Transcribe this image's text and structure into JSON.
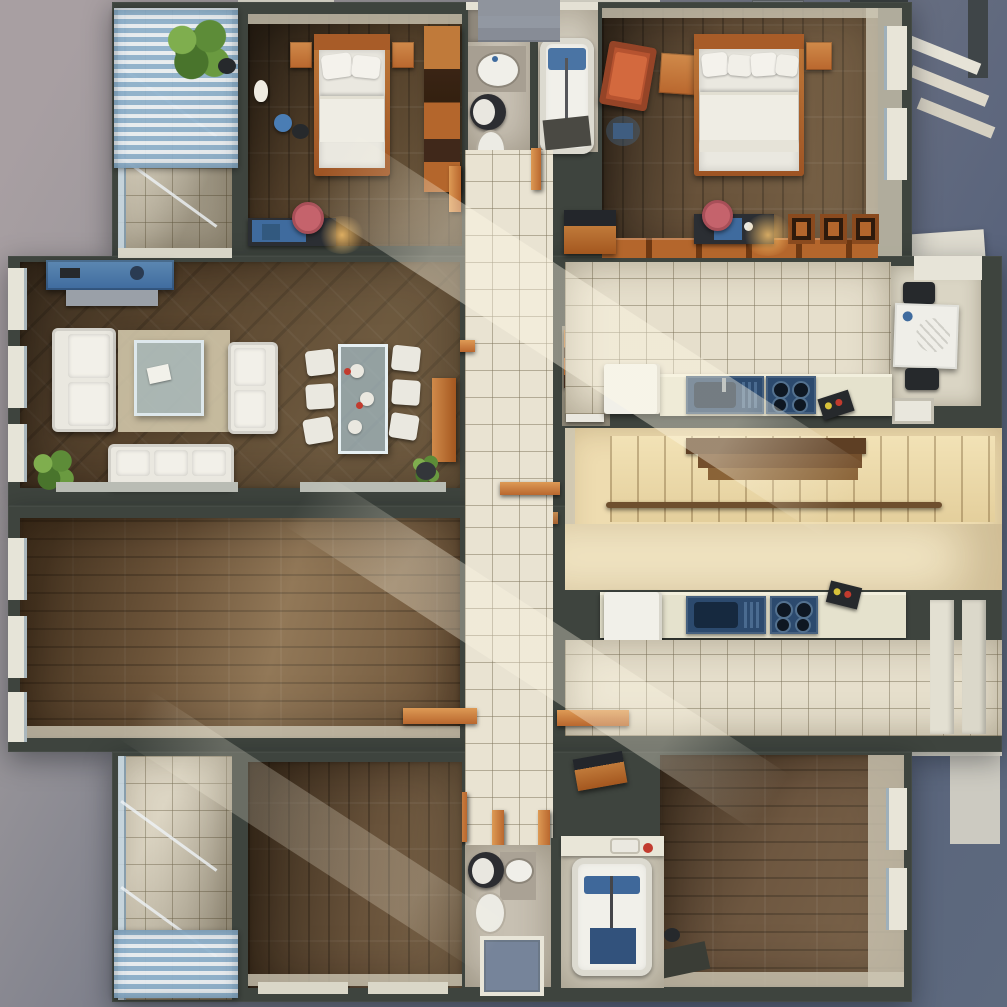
{
  "scene": {
    "type": "3d-floorplan-render",
    "view": "top-down-axonometric",
    "description": "Rendered top view of a two-unit residential floor plan with mirrored apartments, central tiled hallway, shared staircase, left-side balconies with blue striped awnings",
    "units": [
      {
        "name": "upper-apartment",
        "rooms": [
          {
            "name": "balcony-top-left",
            "floor": "tile",
            "items": [
              "striped-awning",
              "palm-plant",
              "glass-railing",
              "planter-pot"
            ]
          },
          {
            "name": "bedroom-single",
            "floor": "wood",
            "items": [
              "single-bed",
              "nightstand-left",
              "nightstand-right",
              "wardrobe",
              "desk",
              "pink-chair",
              "desk-lamp",
              "vase",
              "blue-stool"
            ]
          },
          {
            "name": "bathroom",
            "floor": "stone",
            "items": [
              "sink-counter",
              "toilet",
              "bathtub",
              "blue-bath-mat",
              "dark-floor-mat"
            ]
          },
          {
            "name": "bedroom-double",
            "floor": "wood",
            "items": [
              "double-bed",
              "four-pillows",
              "nightstand",
              "red-lounge-chair",
              "side-table",
              "desk",
              "pink-chair",
              "open-shelving",
              "wardrobe-row",
              "blue-floor-lamp"
            ]
          },
          {
            "name": "living-dining-room",
            "floor": "wood",
            "items": [
              "blue-tv-sideboard",
              "sofa-left",
              "loveseat",
              "sofa-bottom",
              "rug",
              "glass-coffee-table",
              "glass-dining-table",
              "six-dining-chairs",
              "plates",
              "potted-plant",
              "floor-plant",
              "orange-sideboard"
            ]
          },
          {
            "name": "hallway",
            "floor": "tile",
            "items": [
              "open-doors",
              "hall-cabinet",
              "storage-closet",
              "orange-shelf",
              "white-bin"
            ]
          },
          {
            "name": "kitchen",
            "floor": "tile",
            "items": [
              "fridge",
              "counter",
              "blue-sink",
              "blue-stove",
              "black-tray",
              "breakfast-table",
              "two-dark-chairs",
              "wall-sink"
            ]
          }
        ]
      },
      {
        "name": "lower-apartment",
        "rooms": [
          {
            "name": "living-room-lower",
            "floor": "wood",
            "items": []
          },
          {
            "name": "kitchen-lower",
            "floor": "tile",
            "items": [
              "fridge",
              "counter",
              "blue-sink",
              "blue-stove",
              "black-tray"
            ]
          },
          {
            "name": "hallway-lower",
            "floor": "tile",
            "items": [
              "open-doors",
              "hall-cabinet"
            ]
          },
          {
            "name": "bedroom-bottom-left",
            "floor": "wood",
            "items": []
          },
          {
            "name": "bedroom-bottom-right",
            "floor": "wood",
            "items": [
              "dark-mat",
              "small-pot"
            ]
          },
          {
            "name": "bathroom-wc-lower",
            "floor": "stone",
            "items": [
              "toilet",
              "sink-counter",
              "window"
            ]
          },
          {
            "name": "bathroom-tub-lower",
            "floor": "stone",
            "items": [
              "bathtub",
              "blue-bath-mat",
              "navy-mat",
              "sink",
              "red-soap"
            ]
          },
          {
            "name": "balcony-bottom-left",
            "floor": "tile",
            "items": [
              "striped-awning",
              "glass-railing"
            ]
          }
        ]
      }
    ],
    "shared": [
      {
        "name": "staircase",
        "items": [
          "stair-flight",
          "dark-wood-steps",
          "handrail",
          "sunlit-landing"
        ]
      }
    ]
  },
  "colors": {
    "bg-tl": "#a89fa2",
    "bg-tr": "#57627b",
    "bg-br": "#5e6a7e",
    "wall": "#3e443e",
    "face": "#cdc7b4",
    "wood-dark": "#54412b",
    "wood-mid": "#68523a",
    "wood-light": "#7d6244",
    "tile": "#e6dfcc",
    "tile-bright": "#efe9d6",
    "stair": "#eedcb0",
    "stair-bright": "#f5e9c8",
    "white-furn": "#eae8e0",
    "counter": "#e5e2cd",
    "appliance": "#2c4a6e",
    "appliance-dark": "#16293f",
    "orange": "#b9672e",
    "orange-bright": "#d08a4a",
    "awning-blue": "#8fb2cd",
    "awning-white": "#eaeff3",
    "pink": "#c5636c",
    "red": "#c23b2e",
    "blue-desk": "#3f6b9e",
    "glass": "#aebfca",
    "sill": "#e3e0d2",
    "rug": "#d7cdb0",
    "dark-item": "#26292c",
    "stair-wood": "#6e4f2e",
    "window-glass": "#76849a"
  }
}
